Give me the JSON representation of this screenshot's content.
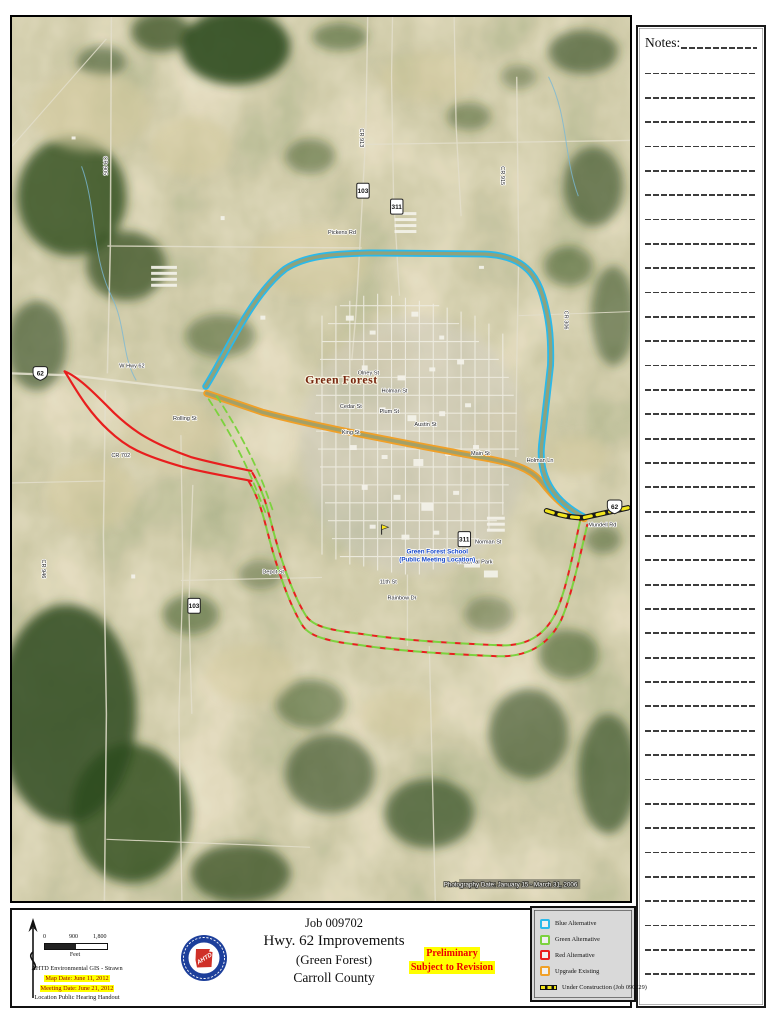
{
  "route_colors": {
    "blue": "#2bb9ea",
    "green": "#7cd23e",
    "red": "#e81e1e",
    "orange": "#f0a028",
    "construction": "#f2e51c"
  },
  "notes": {
    "label": "Notes:",
    "line_count": 38
  },
  "map": {
    "city_label": "Green Forest",
    "school_label": [
      "Green Forest School",
      "(Public Meeting Location)"
    ],
    "photography_date": "Photography Date: January 15 - March 31, 2006",
    "shields": [
      {
        "type": "us",
        "num": "62",
        "x": 20,
        "y": 350
      },
      {
        "type": "us",
        "num": "62",
        "x": 598,
        "y": 484
      },
      {
        "type": "state",
        "num": "103",
        "x": 346,
        "y": 166
      },
      {
        "type": "state",
        "num": "311",
        "x": 380,
        "y": 182
      },
      {
        "type": "state",
        "num": "311",
        "x": 448,
        "y": 516
      },
      {
        "type": "state",
        "num": "103",
        "x": 176,
        "y": 583
      }
    ],
    "street_labels": [
      {
        "t": "Pickens Rd",
        "x": 318,
        "y": 218,
        "r": 0
      },
      {
        "t": "CR 915",
        "x": 492,
        "y": 150,
        "r": 90
      },
      {
        "t": "CR 905",
        "x": 92,
        "y": 140,
        "r": 90
      },
      {
        "t": "CR 913",
        "x": 350,
        "y": 112,
        "r": 90
      },
      {
        "t": "W Hwy 62",
        "x": 108,
        "y": 352,
        "r": 0
      },
      {
        "t": "Olney St",
        "x": 348,
        "y": 359,
        "r": 0
      },
      {
        "t": "Holman St",
        "x": 372,
        "y": 377,
        "r": 0
      },
      {
        "t": "Cedar St",
        "x": 330,
        "y": 393,
        "r": 0
      },
      {
        "t": "Plum St",
        "x": 370,
        "y": 398,
        "r": 0
      },
      {
        "t": "King St",
        "x": 332,
        "y": 419,
        "r": 0
      },
      {
        "t": "Austin St",
        "x": 405,
        "y": 411,
        "r": 0
      },
      {
        "t": "Main St",
        "x": 462,
        "y": 440,
        "r": 0
      },
      {
        "t": "Holman Ln",
        "x": 518,
        "y": 447,
        "r": 0
      },
      {
        "t": "Mundell Rd",
        "x": 580,
        "y": 512,
        "r": 0
      },
      {
        "t": "Rolling St",
        "x": 162,
        "y": 405,
        "r": 0
      },
      {
        "t": "CR 702",
        "x": 100,
        "y": 442,
        "r": 0
      },
      {
        "t": "Depot St",
        "x": 252,
        "y": 559,
        "r": 0
      },
      {
        "t": "11th St",
        "x": 370,
        "y": 569,
        "r": 0
      },
      {
        "t": "Rainbow Dr",
        "x": 378,
        "y": 585,
        "r": 0
      },
      {
        "t": "Norman St",
        "x": 466,
        "y": 529,
        "r": 0
      },
      {
        "t": "Industrial Park",
        "x": 448,
        "y": 549,
        "r": 0
      },
      {
        "t": "CR 946",
        "x": 30,
        "y": 545,
        "r": 90
      },
      {
        "t": "CR 306",
        "x": 556,
        "y": 295,
        "r": 90
      }
    ]
  },
  "footer": {
    "scale": {
      "ticks": [
        "0",
        "900",
        "1,800"
      ],
      "unit": "Feet"
    },
    "credit_line": "AHTD Environmental GIS - Strawn",
    "map_date": "Map Date: June 11, 2012",
    "meeting_date": "Meeting Date: June 21, 2012",
    "location_line": "Location Public Hearing Handout",
    "title_lines": [
      "Job 009702",
      "Hwy. 62 Improvements",
      "(Green Forest)",
      "Carroll County"
    ],
    "stamp_lines": [
      "Preliminary",
      "Subject to Revision"
    ],
    "legend": {
      "items": [
        {
          "label": "Blue Alternative",
          "color_key": "blue",
          "style": "solid"
        },
        {
          "label": "Green Alternative",
          "color_key": "green",
          "style": "dashed"
        },
        {
          "label": "Red Alternative",
          "color_key": "red",
          "style": "solid"
        },
        {
          "label": "Upgrade Existing",
          "color_key": "orange",
          "style": "solid"
        },
        {
          "label": "Under Construction (Job 090229)",
          "color_key": "construction",
          "style": "construction"
        }
      ]
    }
  }
}
